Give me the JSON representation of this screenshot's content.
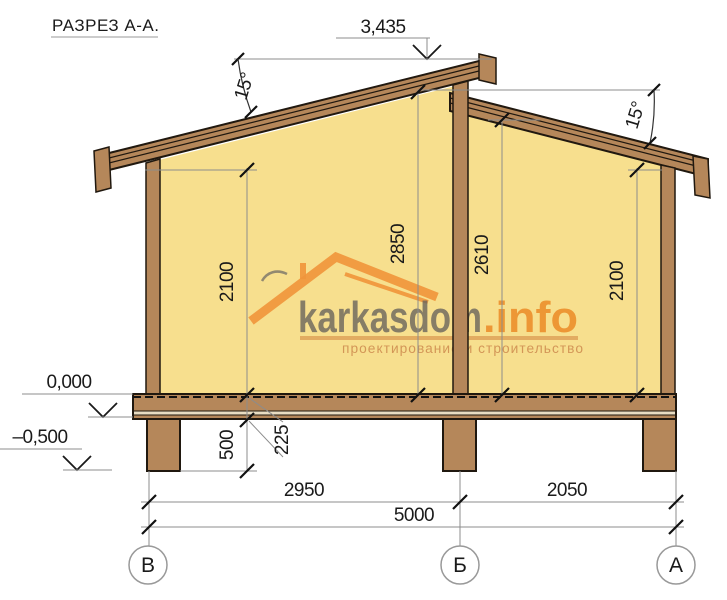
{
  "title": "РАЗРЕЗ А-А.",
  "levels": {
    "ridge": "3,435",
    "zero": "0,000",
    "basement": "–0,500"
  },
  "angles": {
    "left_roof": "15°",
    "right_roof": "15°"
  },
  "dims": {
    "left_wall_height": "2100",
    "mid_left_height": "2850",
    "mid_right_height": "2610",
    "right_wall_height": "2100",
    "foundation_height": "500",
    "floor_thickness": "225",
    "bay_left": "2950",
    "bay_right": "2050",
    "total_span": "5000"
  },
  "axes": {
    "left": "В",
    "center": "Б",
    "right": "А"
  },
  "watermark": {
    "brand": "karkasdom",
    "tld": ".info",
    "tagline": "проектирование и строительство"
  },
  "colors": {
    "wall_fill": "#F7DF8E",
    "wood_fill": "#B5875A",
    "outline": "#20180F",
    "dim_line": "#8C8C8C",
    "text": "#1A1A1A",
    "logo_orange": "#F0963C",
    "watermark_gray": "#69645C"
  }
}
